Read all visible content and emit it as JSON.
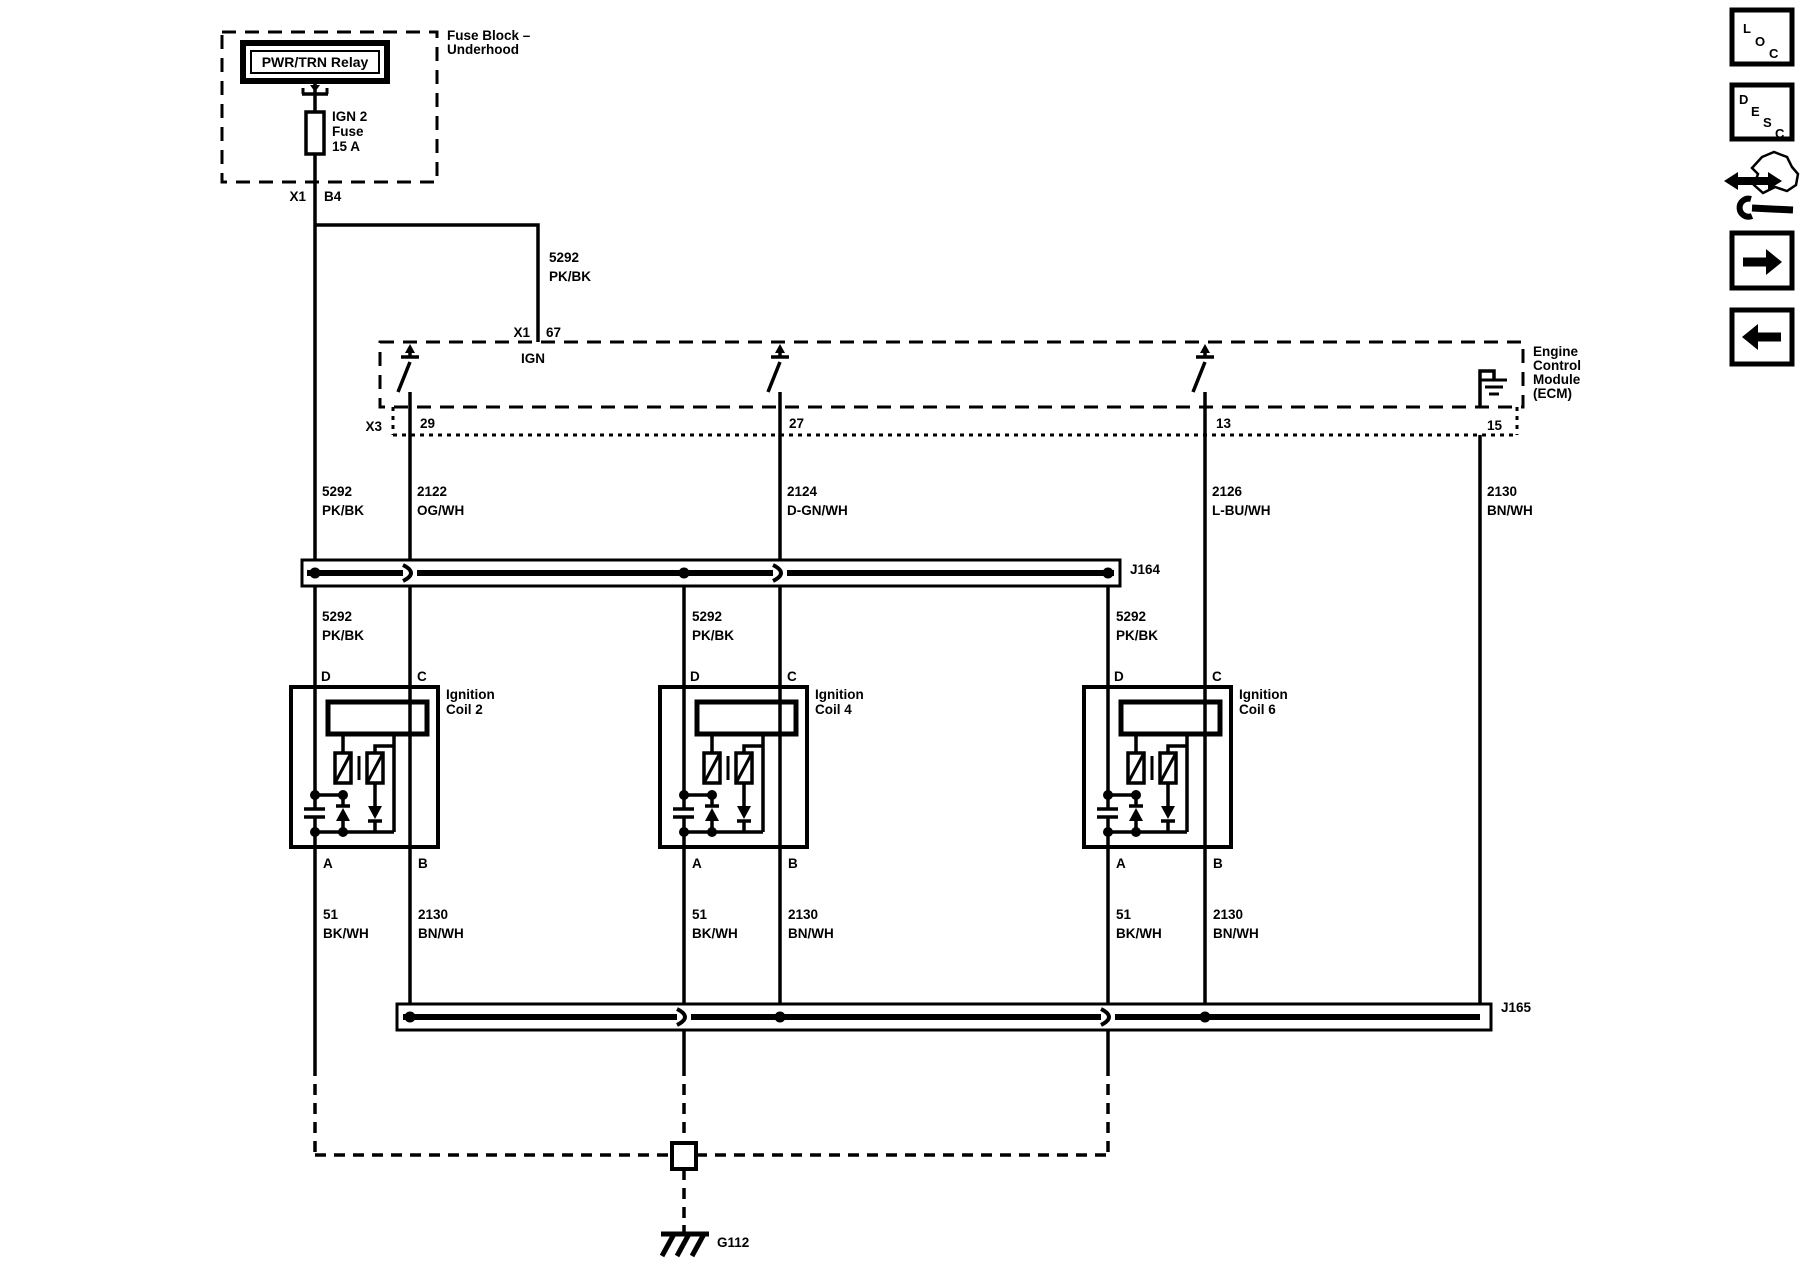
{
  "fuse_block": {
    "title_line1": "Fuse Block –",
    "title_line2": "Underhood",
    "relay_label": "PWR/TRN Relay",
    "fuse_name": "IGN 2",
    "fuse_type": "Fuse",
    "fuse_rating": "15 A",
    "connector": "X1",
    "pin": "B4"
  },
  "ecm": {
    "connector_top": "X1",
    "pin_top": "67",
    "ign_label": "IGN",
    "connector_bottom": "X3",
    "pin_coil2": "29",
    "pin_coil4": "27",
    "pin_coil6": "13",
    "pin_ground": "15",
    "name_line1": "Engine",
    "name_line2": "Control",
    "name_line3": "Module",
    "name_line4": "(ECM)"
  },
  "wires": {
    "ign_feed": {
      "circuit": "5292",
      "color": "PK/BK"
    },
    "coil2_control": {
      "circuit": "2122",
      "color": "OG/WH"
    },
    "coil4_control": {
      "circuit": "2124",
      "color": "D-GN/WH"
    },
    "coil6_control": {
      "circuit": "2126",
      "color": "L-BU/WH"
    },
    "ground_2130": {
      "circuit": "2130",
      "color": "BN/WH"
    },
    "ground_51": {
      "circuit": "51",
      "color": "BK/WH"
    }
  },
  "splices": {
    "j164": "J164",
    "j165": "J165"
  },
  "coils": [
    {
      "name_line1": "Ignition",
      "name_line2": "Coil 2",
      "pin_d": "D",
      "pin_c": "C",
      "pin_a": "A",
      "pin_b": "B"
    },
    {
      "name_line1": "Ignition",
      "name_line2": "Coil 4",
      "pin_d": "D",
      "pin_c": "C",
      "pin_a": "A",
      "pin_b": "B"
    },
    {
      "name_line1": "Ignition",
      "name_line2": "Coil 6",
      "pin_d": "D",
      "pin_c": "C",
      "pin_a": "A",
      "pin_b": "B"
    }
  ],
  "ground": {
    "label": "G112"
  },
  "nav": {
    "loc": [
      "L",
      "O",
      "C"
    ],
    "desc": [
      "D",
      "E",
      "S",
      "C"
    ]
  },
  "colors": {
    "line": "#000000",
    "background": "#ffffff"
  }
}
